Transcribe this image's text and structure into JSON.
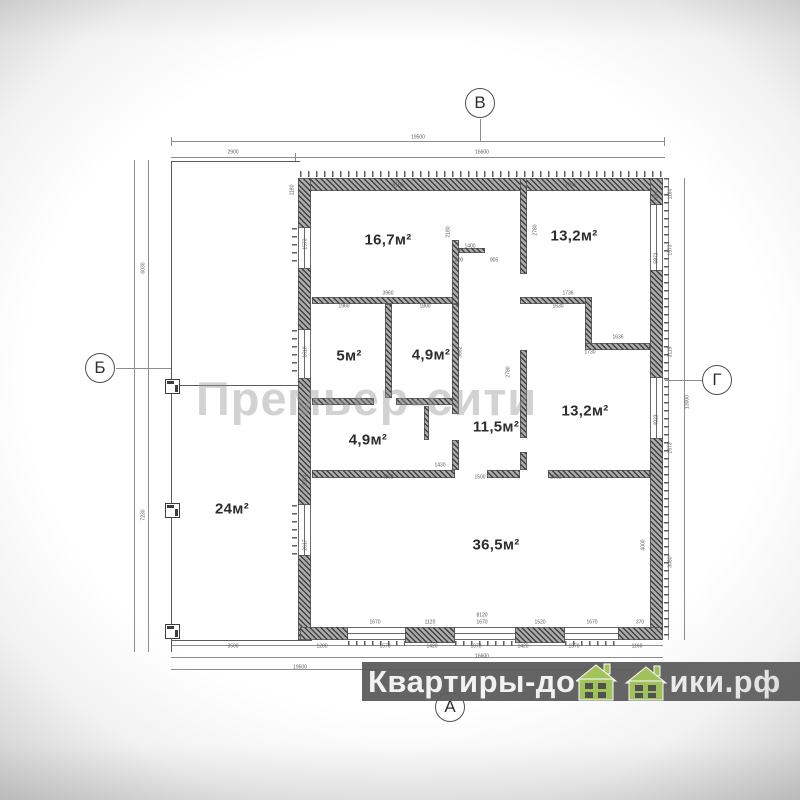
{
  "axes": {
    "top": "В",
    "left": "Б",
    "right": "Г",
    "bottom": "А"
  },
  "watermark": {
    "text": "Премьер-сити"
  },
  "branding": {
    "prefix": "Квартиры-до",
    "suffix": "ики.рф",
    "full_text": "Квартиры-домики.рф",
    "house_color": "#a2c45a",
    "house_window_color": "#4f4f4f",
    "bar_color": "#5c5c5c",
    "text_color": "#f2f2f2"
  },
  "rooms": [
    {
      "label": "16,7м²",
      "x": 388,
      "y": 240
    },
    {
      "label": "13,2м²",
      "x": 574,
      "y": 236
    },
    {
      "label": "5м²",
      "x": 349,
      "y": 356
    },
    {
      "label": "4,9м²",
      "x": 431,
      "y": 355
    },
    {
      "label": "11,5м²",
      "x": 496,
      "y": 427
    },
    {
      "label": "13,2м²",
      "x": 585,
      "y": 411
    },
    {
      "label": "4,9м²",
      "x": 368,
      "y": 440
    },
    {
      "label": "24м²",
      "x": 232,
      "y": 509
    },
    {
      "label": "36,5м²",
      "x": 496,
      "y": 545
    }
  ],
  "dims": [
    {
      "t": "19500",
      "x": 418,
      "y": 138,
      "r": 0
    },
    {
      "t": "2900",
      "x": 233,
      "y": 153,
      "r": 0
    },
    {
      "t": "16600",
      "x": 482,
      "y": 153,
      "r": 0
    },
    {
      "t": "6030",
      "x": 144,
      "y": 268,
      "r": 1
    },
    {
      "t": "7230",
      "x": 144,
      "y": 515,
      "r": 1
    },
    {
      "t": "13000",
      "x": 688,
      "y": 402,
      "r": 1
    },
    {
      "t": "1180",
      "x": 671,
      "y": 194,
      "r": 1
    },
    {
      "t": "1573",
      "x": 671,
      "y": 250,
      "r": 1
    },
    {
      "t": "3115",
      "x": 671,
      "y": 352,
      "r": 1
    },
    {
      "t": "1573",
      "x": 671,
      "y": 448,
      "r": 1
    },
    {
      "t": "3080",
      "x": 671,
      "y": 562,
      "r": 1
    },
    {
      "t": "1180",
      "x": 657,
      "y": 196,
      "r": 1
    },
    {
      "t": "5973",
      "x": 657,
      "y": 258,
      "r": 1
    },
    {
      "t": "4023",
      "x": 657,
      "y": 420,
      "r": 1
    },
    {
      "t": "4000",
      "x": 644,
      "y": 545,
      "r": 1
    },
    {
      "t": "1573",
      "x": 306,
      "y": 244,
      "r": 1
    },
    {
      "t": "1610",
      "x": 306,
      "y": 352,
      "r": 1
    },
    {
      "t": "1093",
      "x": 306,
      "y": 480,
      "r": 1
    },
    {
      "t": "2617",
      "x": 306,
      "y": 545,
      "r": 1
    },
    {
      "t": "1180",
      "x": 293,
      "y": 190,
      "r": 1
    },
    {
      "t": "5560",
      "x": 398,
      "y": 186,
      "r": 0
    },
    {
      "t": "3380",
      "x": 570,
      "y": 186,
      "r": 0
    },
    {
      "t": "2180",
      "x": 449,
      "y": 232,
      "r": 1
    },
    {
      "t": "2780",
      "x": 536,
      "y": 230,
      "r": 1
    },
    {
      "t": "1400",
      "x": 470,
      "y": 247,
      "r": 0
    },
    {
      "t": "800",
      "x": 459,
      "y": 261,
      "r": 0
    },
    {
      "t": "905",
      "x": 494,
      "y": 261,
      "r": 0
    },
    {
      "t": "1736",
      "x": 568,
      "y": 294,
      "r": 0
    },
    {
      "t": "1630",
      "x": 558,
      "y": 307,
      "r": 0
    },
    {
      "t": "3960",
      "x": 388,
      "y": 294,
      "r": 0
    },
    {
      "t": "1960",
      "x": 344,
      "y": 307,
      "r": 0
    },
    {
      "t": "1800",
      "x": 425,
      "y": 307,
      "r": 0
    },
    {
      "t": "1636",
      "x": 618,
      "y": 338,
      "r": 0
    },
    {
      "t": "1730",
      "x": 590,
      "y": 353,
      "r": 0
    },
    {
      "t": "2780",
      "x": 509,
      "y": 372,
      "r": 1
    },
    {
      "t": "3662",
      "x": 461,
      "y": 352,
      "r": 1
    },
    {
      "t": "2562",
      "x": 556,
      "y": 478,
      "r": 0
    },
    {
      "t": "1500",
      "x": 480,
      "y": 478,
      "r": 0
    },
    {
      "t": "1430",
      "x": 440,
      "y": 466,
      "r": 0
    },
    {
      "t": "4060",
      "x": 388,
      "y": 478,
      "r": 0
    },
    {
      "t": "8120",
      "x": 482,
      "y": 616,
      "r": 0
    },
    {
      "t": "1670",
      "x": 375,
      "y": 623,
      "r": 0
    },
    {
      "t": "1120",
      "x": 430,
      "y": 623,
      "r": 0
    },
    {
      "t": "1670",
      "x": 482,
      "y": 623,
      "r": 0
    },
    {
      "t": "1520",
      "x": 540,
      "y": 623,
      "r": 0
    },
    {
      "t": "1670",
      "x": 592,
      "y": 623,
      "r": 0
    },
    {
      "t": "370",
      "x": 640,
      "y": 623,
      "r": 0
    },
    {
      "t": "1280",
      "x": 322,
      "y": 647,
      "r": 0
    },
    {
      "t": "1570",
      "x": 385,
      "y": 647,
      "r": 0
    },
    {
      "t": "1420",
      "x": 432,
      "y": 647,
      "r": 0
    },
    {
      "t": "1070",
      "x": 476,
      "y": 647,
      "r": 0
    },
    {
      "t": "1420",
      "x": 523,
      "y": 647,
      "r": 0
    },
    {
      "t": "1570",
      "x": 574,
      "y": 647,
      "r": 0
    },
    {
      "t": "1160",
      "x": 637,
      "y": 647,
      "r": 0
    },
    {
      "t": "3500",
      "x": 233,
      "y": 647,
      "r": 0
    },
    {
      "t": "16600",
      "x": 482,
      "y": 657,
      "r": 0
    },
    {
      "t": "19500",
      "x": 300,
      "y": 668,
      "r": 0
    }
  ]
}
